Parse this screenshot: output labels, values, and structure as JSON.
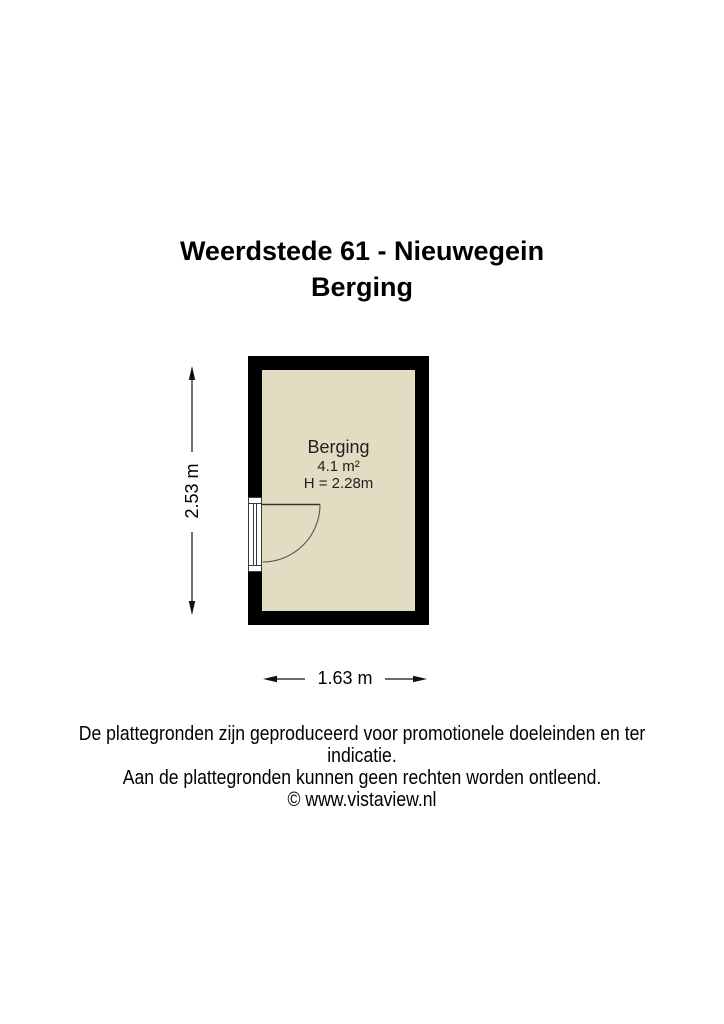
{
  "page": {
    "title_line1": "Weerdstede 61 - Nieuwegein",
    "title_line2": "Berging"
  },
  "floorplan": {
    "room": {
      "name": "Berging",
      "area": "4.1 m²",
      "ceiling_height": "H = 2.28m"
    },
    "dimensions": {
      "height_label": "2.53 m",
      "width_label": "1.63 m"
    },
    "colors": {
      "wall": "#000000",
      "floor": "#E2DCC3",
      "door_line": "#3a3a3a"
    }
  },
  "footer": {
    "disclaimer_line1": "De plattegronden zijn geproduceerd voor promotionele doeleinden en ter indicatie.",
    "disclaimer_line2": "Aan de plattegronden kunnen geen rechten worden ontleend.",
    "copyright": "© www.vistaview.nl"
  }
}
